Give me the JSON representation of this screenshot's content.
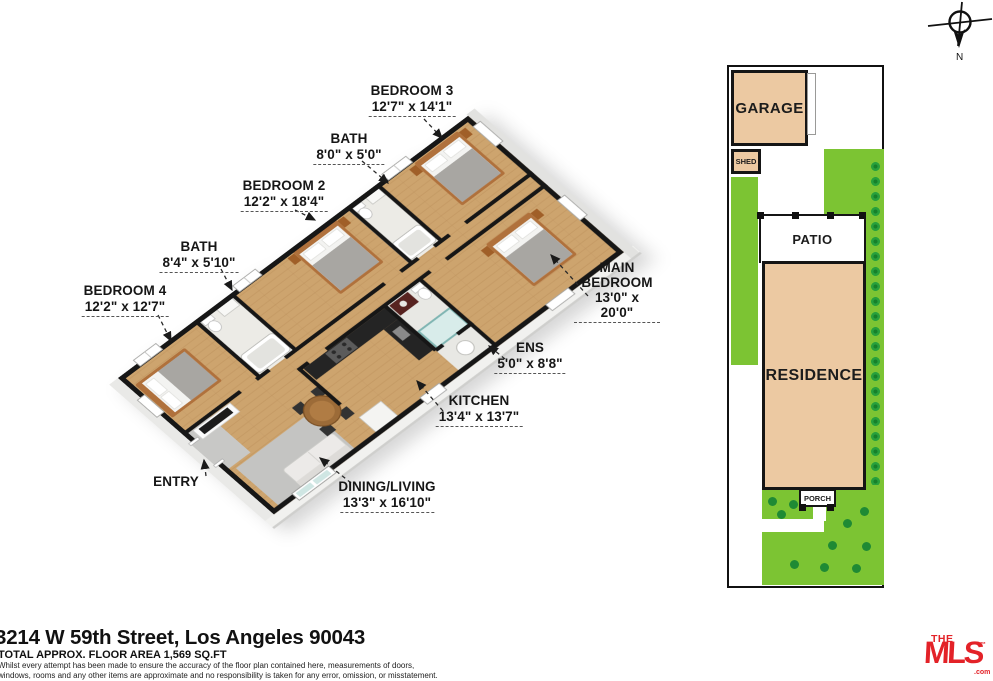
{
  "compass": {
    "north": "N"
  },
  "floor_plan": {
    "labels": [
      {
        "name": "BEDROOM 3",
        "dims": "12'7\" x 14'1\""
      },
      {
        "name": "BATH",
        "dims": "8'0\" x 5'0\""
      },
      {
        "name": "BEDROOM 2",
        "dims": "12'2\" x 18'4\""
      },
      {
        "name": "BATH",
        "dims": "8'4\" x 5'10\""
      },
      {
        "name": "BEDROOM 4",
        "dims": "12'2\" x 12'7\""
      },
      {
        "name": "MAIN BEDROOM",
        "dims": "13'0\" x 20'0\""
      },
      {
        "name": "ENS",
        "dims": "5'0\" x 8'8\""
      },
      {
        "name": "KITCHEN",
        "dims": "13'4\" x 13'7\""
      },
      {
        "name": "DINING/LIVING",
        "dims": "13'3\" x 16'10\""
      },
      {
        "name": "ENTRY",
        "dims": ""
      }
    ]
  },
  "site_plan": {
    "garage": "GARAGE",
    "shed": "SHED",
    "patio": "PATIO",
    "residence": "RESIDENCE",
    "porch": "PORCH"
  },
  "footer": {
    "address": "3214 W 59th Street, Los Angeles 90043",
    "area": "TOTAL APPROX. FLOOR AREA 1,569 SQ.FT",
    "disclaimer1": "Whilst every attempt has been made to ensure the accuracy of the floor plan contained here, measurements of doors,",
    "disclaimer2": "windows, rooms and any other items are approximate and no responsibility is taken for any error, omission, or misstatement.",
    "disclaimer3": "This plan is for illustrative purposes only and should be used as such by any prospective purchaser."
  },
  "logo": {
    "the": "THE",
    "mls": "MLS",
    "tm": "™",
    "com": ".com"
  },
  "colors": {
    "wood_floor": "#cda46e",
    "wall": "#161616",
    "lot_tan": "#ecc9a2",
    "grass_green": "#7cc433",
    "shrub_green": "#1f8a34",
    "accent_red": "#e32228"
  }
}
